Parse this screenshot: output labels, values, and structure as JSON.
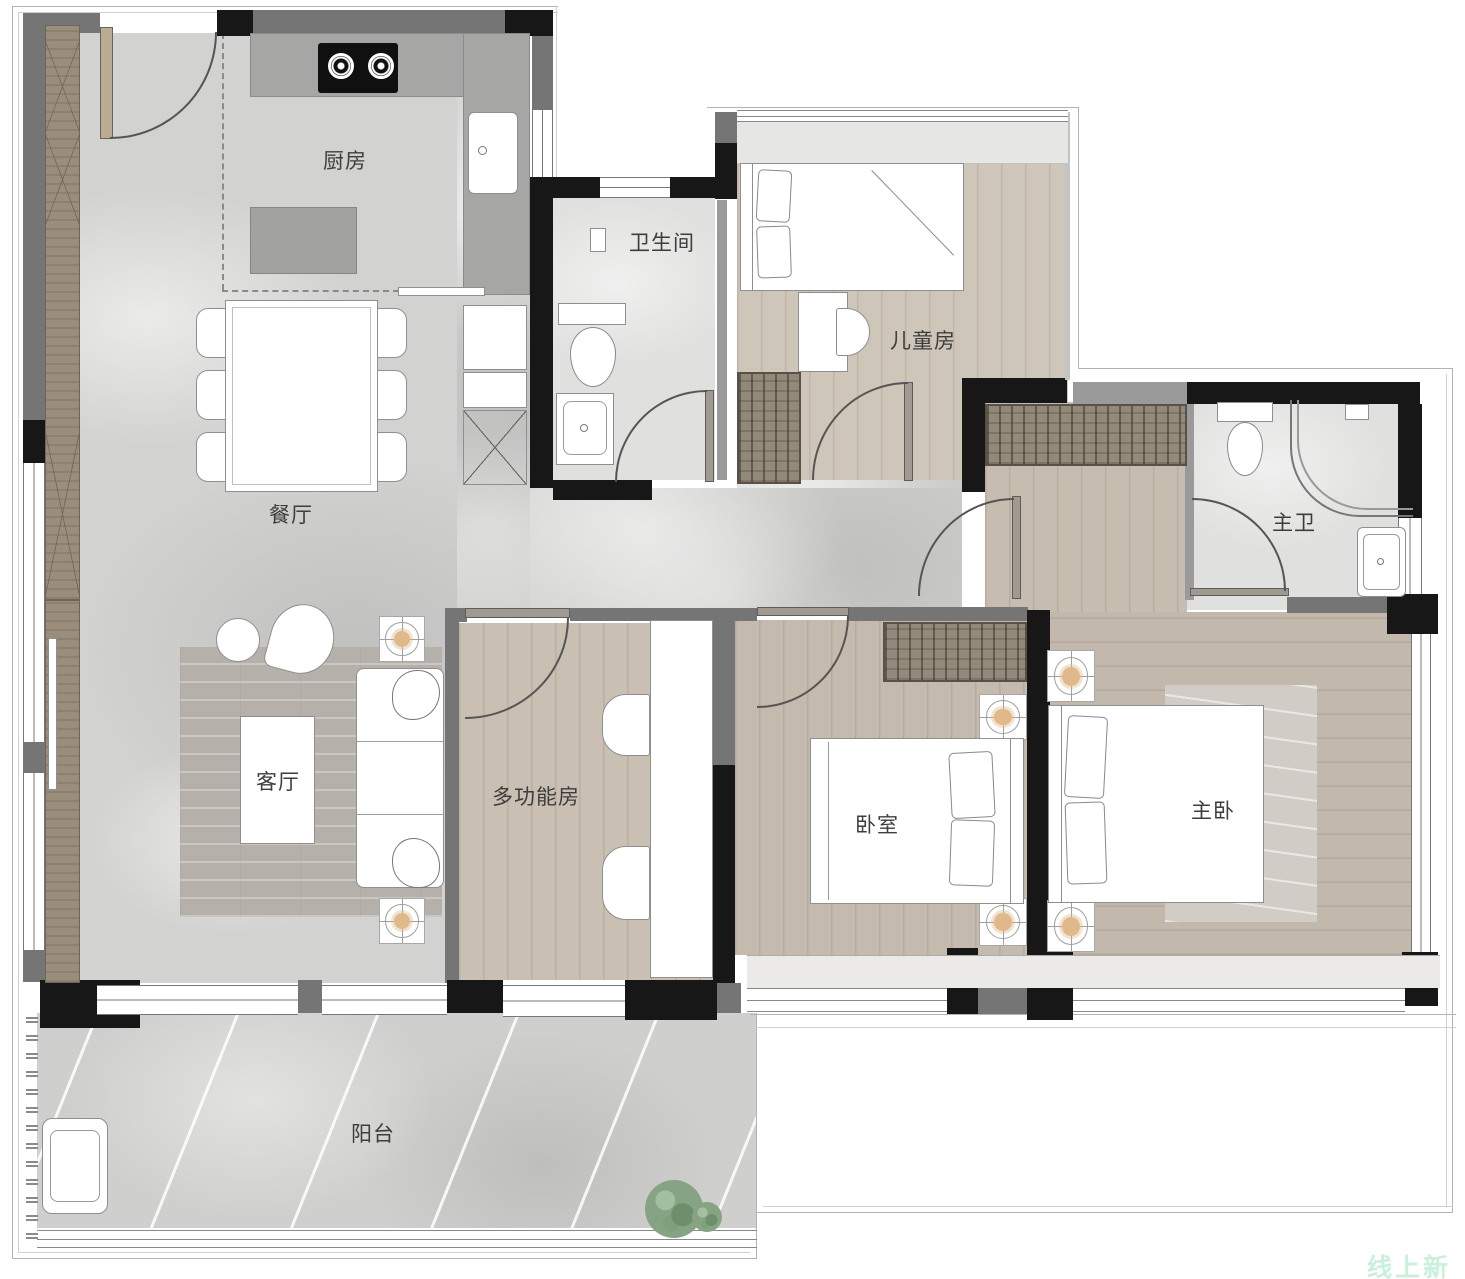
{
  "floorplan": {
    "rooms": [
      {
        "id": "kitchen",
        "label": "厨房"
      },
      {
        "id": "bathroom",
        "label": "卫生间"
      },
      {
        "id": "kids-room",
        "label": "儿童房"
      },
      {
        "id": "dining-room",
        "label": "餐厅"
      },
      {
        "id": "master-bathroom",
        "label": "主卫"
      },
      {
        "id": "living-room",
        "label": "客厅"
      },
      {
        "id": "multifunction-room",
        "label": "多功能房"
      },
      {
        "id": "bedroom",
        "label": "卧室"
      },
      {
        "id": "master-bedroom",
        "label": "主卧"
      },
      {
        "id": "balcony",
        "label": "阳台"
      }
    ],
    "watermark": "线上新房",
    "colors": {
      "wall": "#171717",
      "wood_floor": "#cbc1b4",
      "marble_floor": "#d2d2d0",
      "lamp_accent": "#dfb98a",
      "watermark_green": "#c9f0da"
    }
  }
}
